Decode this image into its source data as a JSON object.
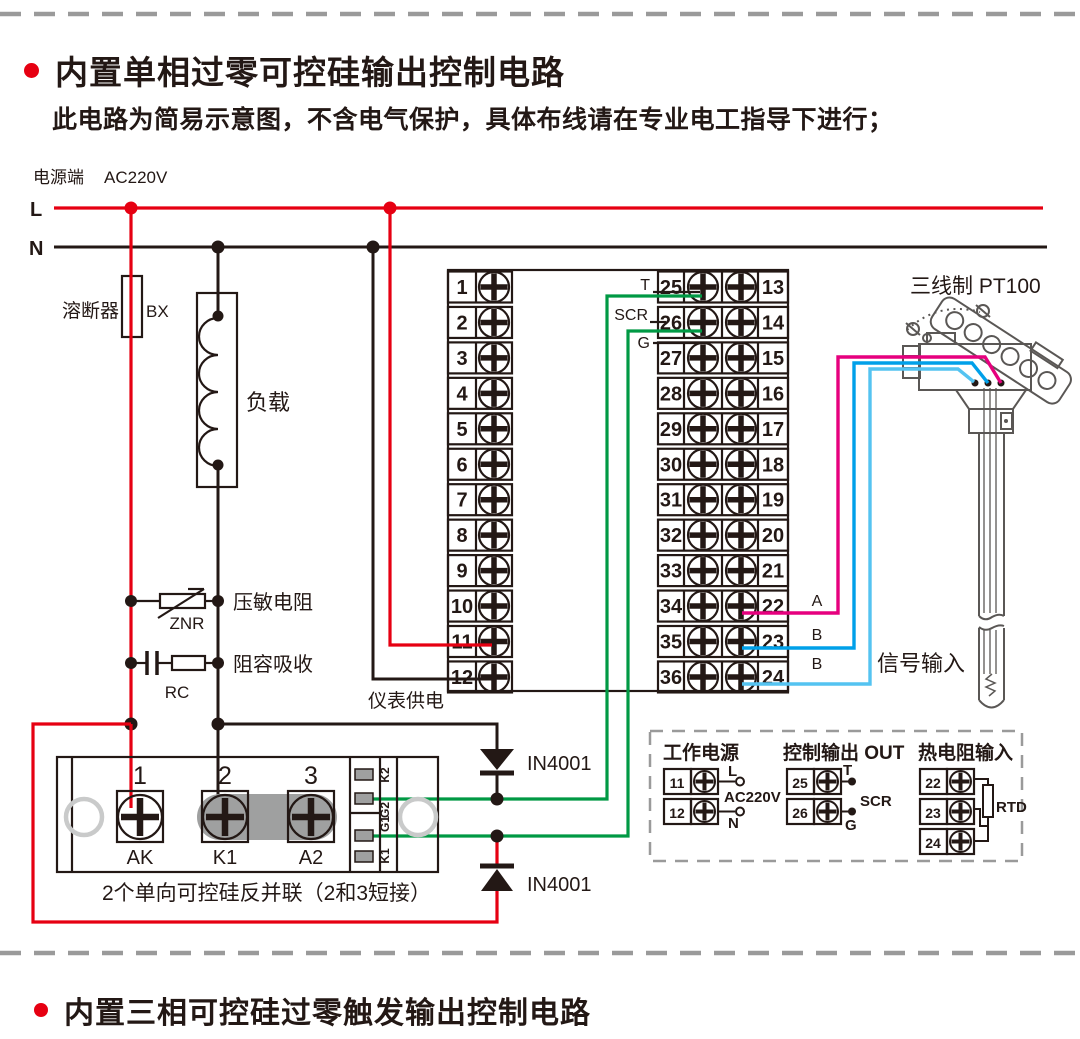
{
  "sections": {
    "top_title": "内置单相过零可控硅输出控制电路",
    "top_note": "此电路为简易示意图，不含电气保护，具体布线请在专业电工指导下进行；",
    "bottom_title": "内置三相可控硅过零触发输出控制电路"
  },
  "power": {
    "source_label": "电源端",
    "voltage": "AC220V",
    "live": "L",
    "neutral": "N"
  },
  "components": {
    "fuse_name": "溶断器",
    "fuse_code": "BX",
    "load": "负载",
    "varistor_name": "压敏电阻",
    "varistor_code": "ZNR",
    "snubber_name": "阻容吸收",
    "snubber_code": "RC",
    "meter_supply": "仪表供电",
    "diode_top": "IN4001",
    "diode_bottom": "IN4001",
    "scr_caption": "2个单向可控硅反并联（2和3短接）"
  },
  "terminal_block": {
    "left_numbers": [
      "1",
      "2",
      "3",
      "4",
      "5",
      "6",
      "7",
      "8",
      "9",
      "10",
      "11",
      "12"
    ],
    "mid_numbers": [
      "25",
      "26",
      "27",
      "28",
      "29",
      "30",
      "31",
      "32",
      "33",
      "34",
      "35",
      "36"
    ],
    "right_numbers": [
      "13",
      "14",
      "15",
      "16",
      "17",
      "18",
      "19",
      "20",
      "21",
      "22",
      "23",
      "24"
    ],
    "label_t": "T",
    "label_scr": "SCR",
    "label_g": "G"
  },
  "scr_module": {
    "terminals": [
      "1",
      "2",
      "3"
    ],
    "names": [
      "AK",
      "K1",
      "A2"
    ],
    "pins": [
      "K2",
      "G2",
      "G1",
      "K1"
    ]
  },
  "sensor": {
    "title": "三线制 PT100",
    "labels": [
      "A",
      "B",
      "B"
    ],
    "signal": "信号输入"
  },
  "inset": {
    "power": {
      "title": "工作电源",
      "t1": "11",
      "t2": "12",
      "l": "L",
      "n": "N",
      "voltage": "AC220V"
    },
    "output": {
      "title": "控制输出 OUT",
      "t1": "25",
      "t2": "26",
      "t": "T",
      "scr": "SCR",
      "g": "G"
    },
    "rtd": {
      "title": "热电阻输入",
      "t1": "22",
      "t2": "23",
      "t3": "24",
      "rtd": "RTD"
    }
  },
  "colors": {
    "red": "#e60012",
    "green": "#009944",
    "magenta": "#e6007e",
    "blue": "#00a0e9",
    "light_blue": "#54c3f1",
    "ink": "#231815",
    "gray": "#9fa0a0"
  }
}
